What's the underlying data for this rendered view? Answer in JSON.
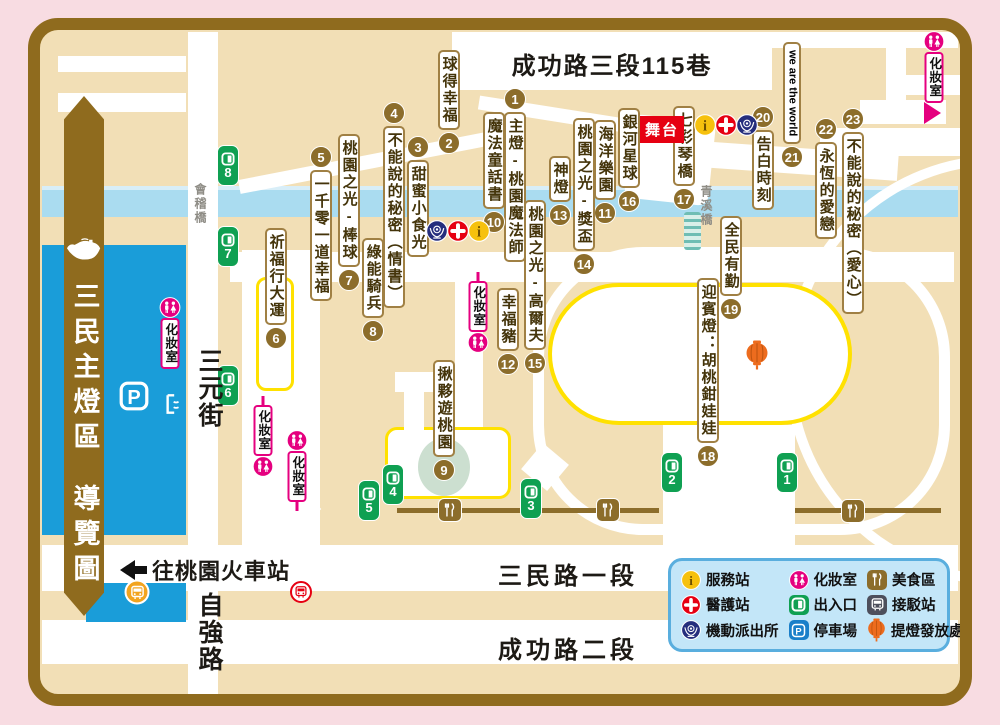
{
  "title": "三民主燈區 導覽圖",
  "banner": {
    "line1": "三民主燈區",
    "line2": "導覽圖"
  },
  "roads": {
    "top": {
      "text": "成功路三段115巷"
    },
    "sanmin1": {
      "text": "三民路一段"
    },
    "chenggong2": {
      "text": "成功路二段"
    },
    "sanyuan": {
      "text": "三元街"
    },
    "ziqiang": {
      "text": "自強路"
    }
  },
  "bridges": {
    "left": {
      "text": "會稽橋"
    },
    "right": {
      "text": "青溪橋"
    }
  },
  "stage": {
    "text": "舞台"
  },
  "station_note": {
    "text": "往桃園火車站"
  },
  "restroom_label": "化妝室",
  "lanterns": [
    {
      "n": "1",
      "name": "主燈-桃園魔法師",
      "x": 515,
      "top": 88,
      "badge": "above"
    },
    {
      "n": "2",
      "name": "球得幸福",
      "x": 449,
      "top": 50,
      "badge": "below"
    },
    {
      "n": "3",
      "name": "甜蜜小食光",
      "x": 418,
      "top": 136,
      "badge": "above"
    },
    {
      "n": "4",
      "name": "不能說的秘密（情書）",
      "x": 394,
      "top": 102,
      "badge": "above"
    },
    {
      "n": "5",
      "name": "一千零一道幸福",
      "x": 321,
      "top": 146,
      "badge": "above"
    },
    {
      "n": "6",
      "name": "祈福行大運",
      "x": 276,
      "top": 228,
      "badge": "below"
    },
    {
      "n": "7",
      "name": "桃園之光-棒球",
      "x": 349,
      "top": 134,
      "badge": "below"
    },
    {
      "n": "8",
      "name": "綠能騎兵",
      "x": 373,
      "top": 238,
      "badge": "below"
    },
    {
      "n": "9",
      "name": "揪夥遊桃園",
      "x": 444,
      "top": 360,
      "badge": "below"
    },
    {
      "n": "10",
      "name": "魔法童話書",
      "x": 494,
      "top": 112,
      "badge": "below"
    },
    {
      "n": "11",
      "name": "海洋樂園",
      "x": 605,
      "top": 120,
      "badge": "below"
    },
    {
      "n": "12",
      "name": "幸福豬",
      "x": 508,
      "top": 288,
      "badge": "below"
    },
    {
      "n": "13",
      "name": "神燈",
      "x": 560,
      "top": 156,
      "badge": "below"
    },
    {
      "n": "14",
      "name": "桃園之光-獎盃",
      "x": 584,
      "top": 118,
      "badge": "below"
    },
    {
      "n": "15",
      "name": "桃園之光-高爾夫",
      "x": 535,
      "top": 200,
      "badge": "below"
    },
    {
      "n": "16",
      "name": "銀河星球",
      "x": 629,
      "top": 108,
      "badge": "below"
    },
    {
      "n": "17",
      "name": "七彩琴橋",
      "x": 684,
      "top": 106,
      "badge": "below"
    },
    {
      "n": "18",
      "name": "迎賓燈：胡桃鉗娃娃",
      "x": 708,
      "top": 278,
      "badge": "below"
    },
    {
      "n": "19",
      "name": "全民有勤",
      "x": 731,
      "top": 216,
      "badge": "below"
    },
    {
      "n": "20",
      "name": "告白時刻",
      "x": 763,
      "top": 106,
      "badge": "above"
    },
    {
      "n": "21",
      "name": "we are the world",
      "x": 792,
      "top": 42,
      "badge": "below",
      "en": true
    },
    {
      "n": "22",
      "name": "永恆的愛戀",
      "x": 826,
      "top": 118,
      "badge": "above"
    },
    {
      "n": "23",
      "name": "不能說的秘密（愛心）",
      "x": 853,
      "top": 108,
      "badge": "above"
    }
  ],
  "exits": [
    {
      "n": "1",
      "x": 787,
      "top": 452
    },
    {
      "n": "2",
      "x": 672,
      "top": 452
    },
    {
      "n": "3",
      "x": 531,
      "top": 478
    },
    {
      "n": "4",
      "x": 393,
      "top": 464
    },
    {
      "n": "5",
      "x": 369,
      "top": 480
    },
    {
      "n": "6",
      "x": 228,
      "top": 365
    },
    {
      "n": "7",
      "x": 228,
      "top": 226
    },
    {
      "n": "8",
      "x": 228,
      "top": 145
    }
  ],
  "restrooms": [
    {
      "x": 934,
      "top": 31,
      "order": "icon-label",
      "stick": "none"
    },
    {
      "x": 170,
      "top": 297,
      "order": "icon-label",
      "stick": "none"
    },
    {
      "x": 263,
      "top": 396,
      "order": "label-icon",
      "stick": "above"
    },
    {
      "x": 297,
      "top": 430,
      "order": "icon-label",
      "stick": "below"
    },
    {
      "x": 478,
      "top": 272,
      "order": "label-icon",
      "stick": "above"
    }
  ],
  "service_points": [
    {
      "type": "police",
      "x": 437,
      "y": 231
    },
    {
      "type": "medical",
      "x": 458,
      "y": 231
    },
    {
      "type": "info",
      "x": 479,
      "y": 231
    },
    {
      "type": "info",
      "x": 705,
      "y": 125
    },
    {
      "type": "medical",
      "x": 726,
      "y": 125
    },
    {
      "type": "police",
      "x": 747,
      "y": 125
    }
  ],
  "food_stalls": [
    {
      "x": 450,
      "y": 510
    },
    {
      "x": 608,
      "y": 510
    },
    {
      "x": 853,
      "y": 511
    }
  ],
  "lantern_pickup": {
    "x": 757,
    "y": 355
  },
  "parking_spot": {
    "x": 134,
    "y": 396
  },
  "shuttle_bus_stop": {
    "x": 137,
    "y": 592
  },
  "train_stop": {
    "x": 301,
    "y": 592
  },
  "legend": {
    "items": [
      {
        "icon": "info",
        "label": "服務站"
      },
      {
        "icon": "medical",
        "label": "醫護站"
      },
      {
        "icon": "police",
        "label": "機動派出所"
      },
      {
        "icon": "restroom",
        "label": "化妝室"
      },
      {
        "icon": "exitdoor",
        "label": "出入口"
      },
      {
        "icon": "parking",
        "label": "停車場"
      },
      {
        "icon": "food",
        "label": "美食區"
      },
      {
        "icon": "bus",
        "label": "接駁站"
      },
      {
        "icon": "lantern",
        "label": "提燈發放處"
      }
    ]
  },
  "colors": {
    "page_bg": "#f8dce2",
    "frame": "#8f6b1e",
    "block": "#f2dfb6",
    "road": "#ffffff",
    "river": "#aadcf0",
    "river_light": "#d8eef8",
    "pond": "#1a9dd9",
    "oval_border": "#ffe100",
    "exit_green": "#0fa052",
    "badge_brown": "#8c6d2b",
    "label_border": "#a08044",
    "magenta": "#e5007f",
    "red": "#e60012",
    "police_blue": "#252e7d",
    "info_yellow": "#f6c10e",
    "orange": "#ed6c1e",
    "legend_bg": "#c3e6f8",
    "legend_border": "#59aede",
    "brown_line": "#8c6d2b",
    "bus_slate": "#4d4f5c",
    "parking_blue": "#1a7fc9"
  }
}
